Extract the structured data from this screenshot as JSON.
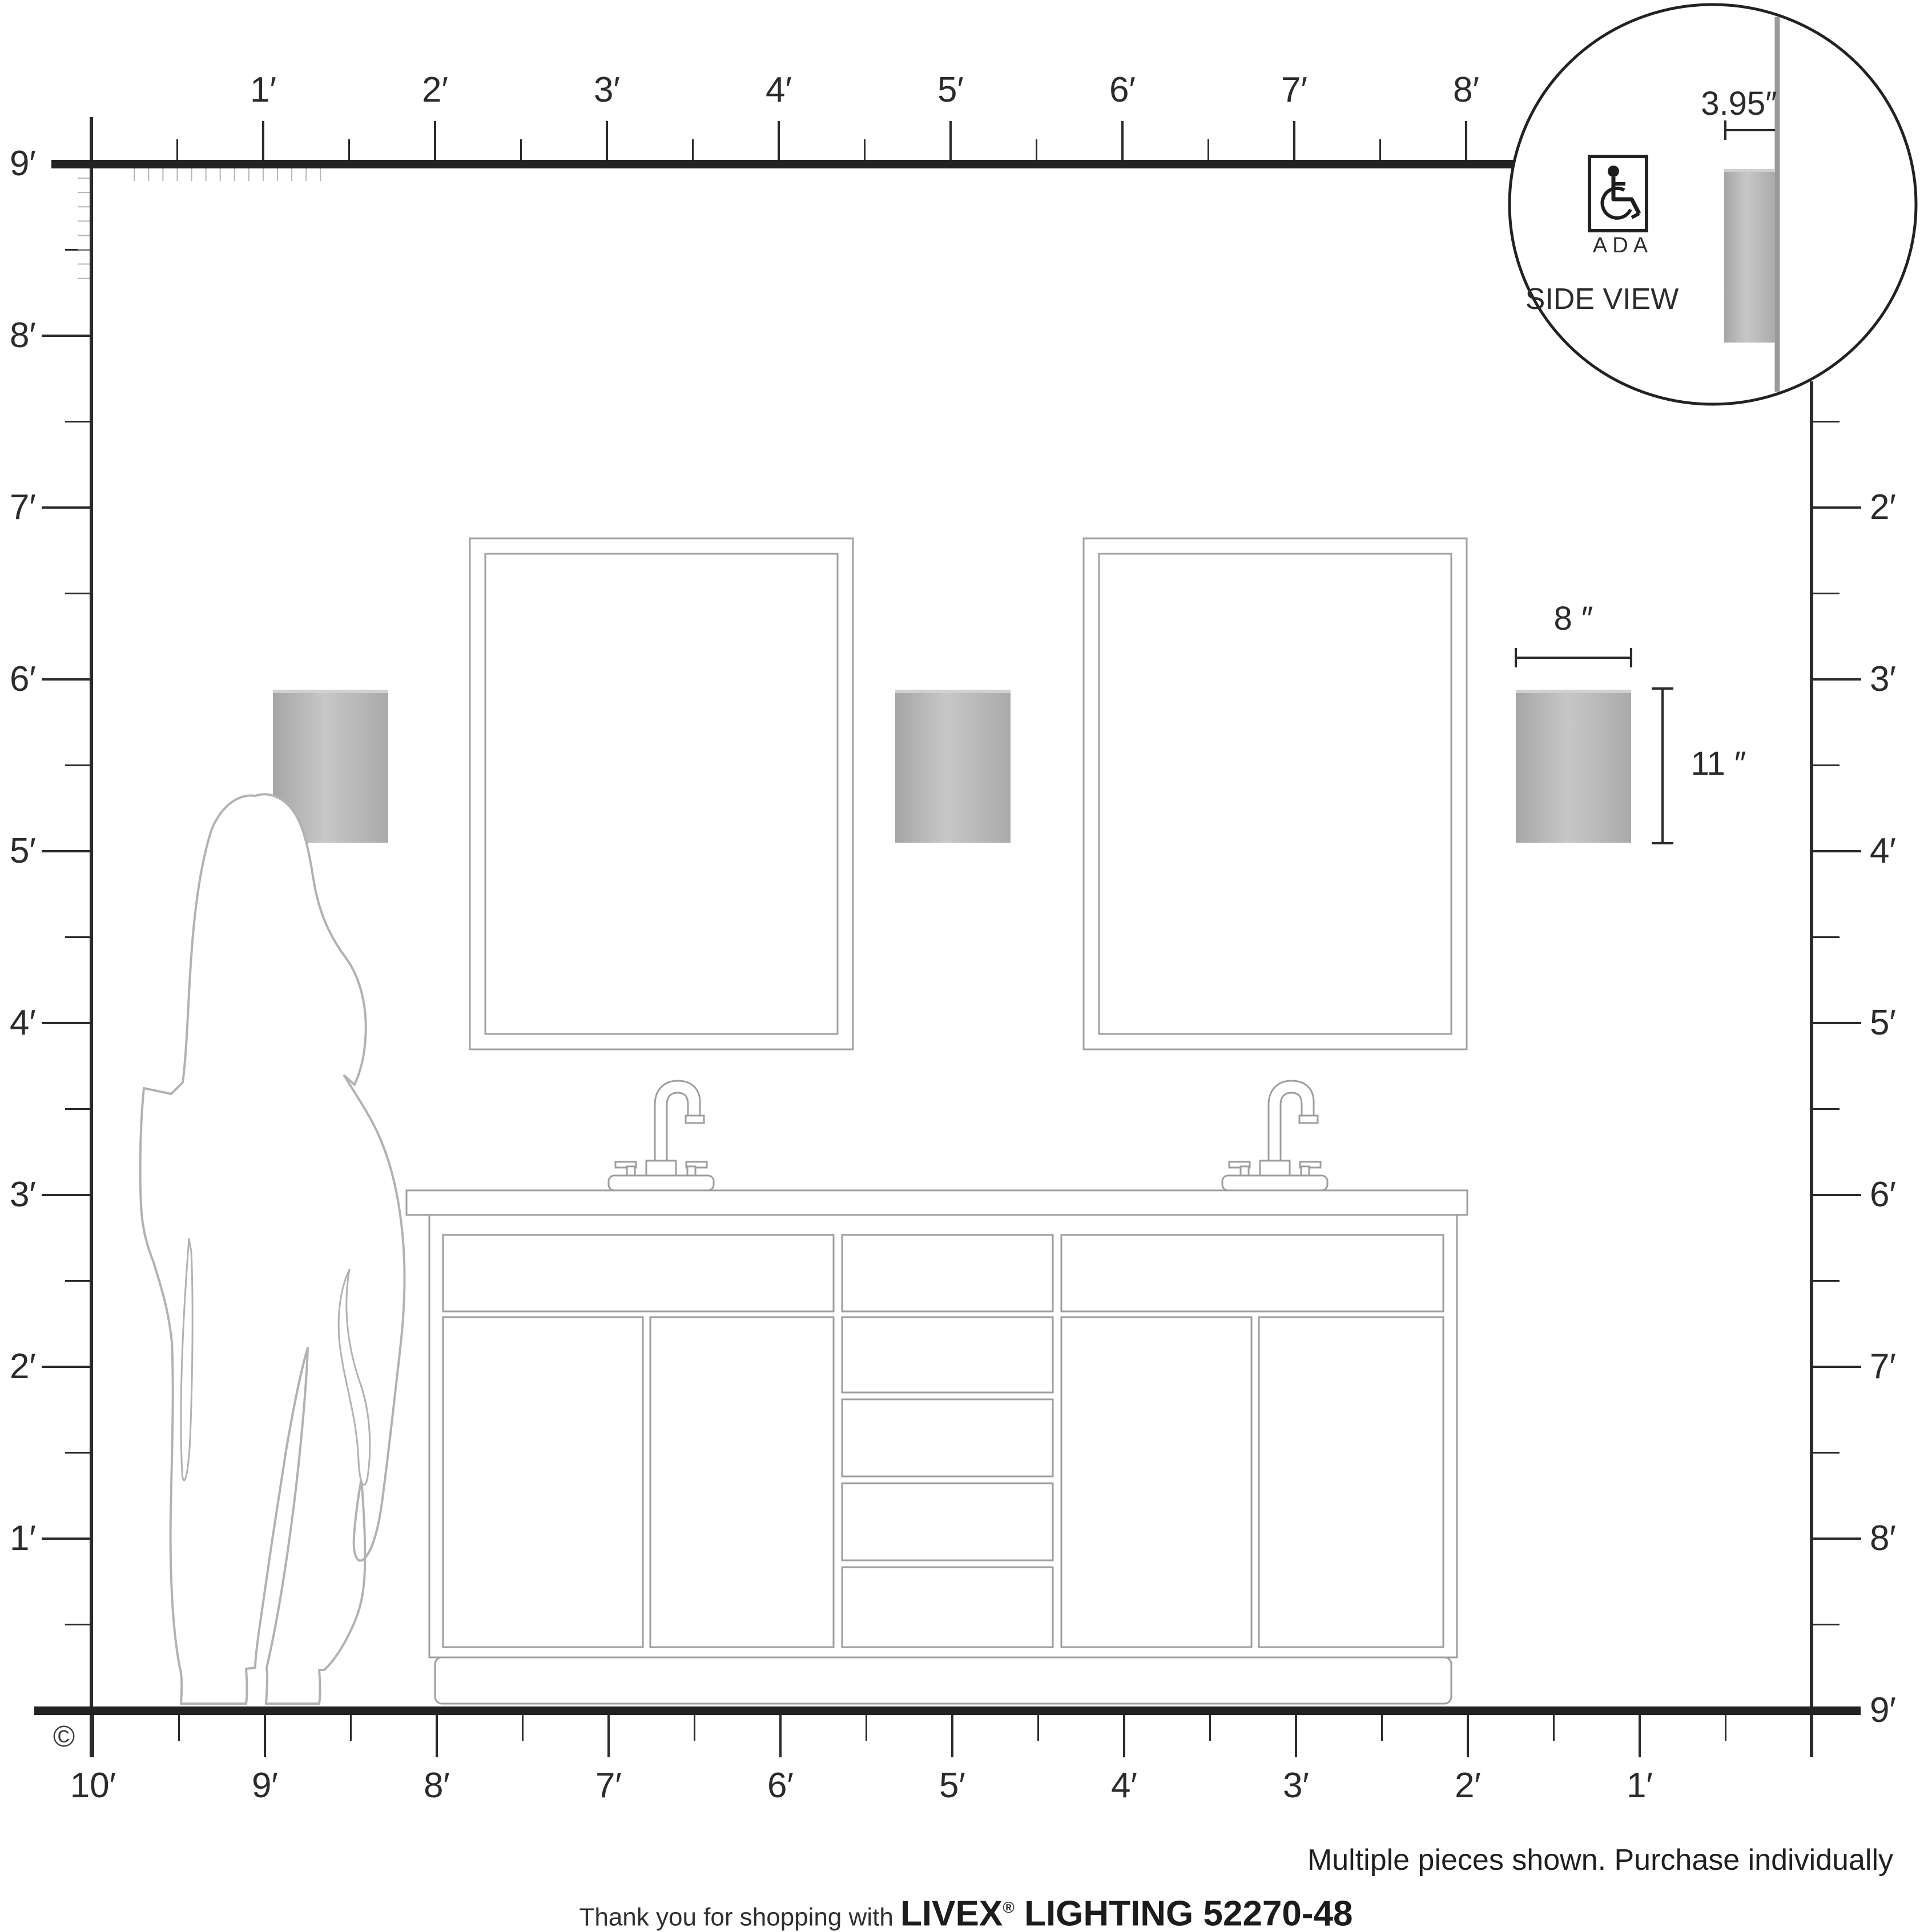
{
  "rulers": {
    "top": [
      "1′",
      "2′",
      "3′",
      "4′",
      "5′",
      "6′",
      "7′",
      "8′"
    ],
    "left": [
      "9′",
      "8′",
      "7′",
      "6′",
      "5′",
      "4′",
      "3′",
      "2′",
      "1′"
    ],
    "right": [
      "2′",
      "3′",
      "4′",
      "5′",
      "6′",
      "7′",
      "8′",
      "9′"
    ],
    "bottom": [
      "10′",
      "9′",
      "8′",
      "7′",
      "6′",
      "5′",
      "4′",
      "3′",
      "2′",
      "1′"
    ]
  },
  "detail_view": {
    "depth_label": "3.95″",
    "ada_label": "ADA",
    "title": "SIDE VIEW"
  },
  "dimensions": {
    "width_label": "8 ″",
    "height_label": "11 ″"
  },
  "footer": {
    "copyright": "©",
    "note": "Multiple pieces shown. Purchase individually",
    "thanks_prefix": "Thank you for shopping with ",
    "brand": "LIVEX",
    "registered": "®",
    "brand_suffix": " LIGHTING 52270-48"
  }
}
